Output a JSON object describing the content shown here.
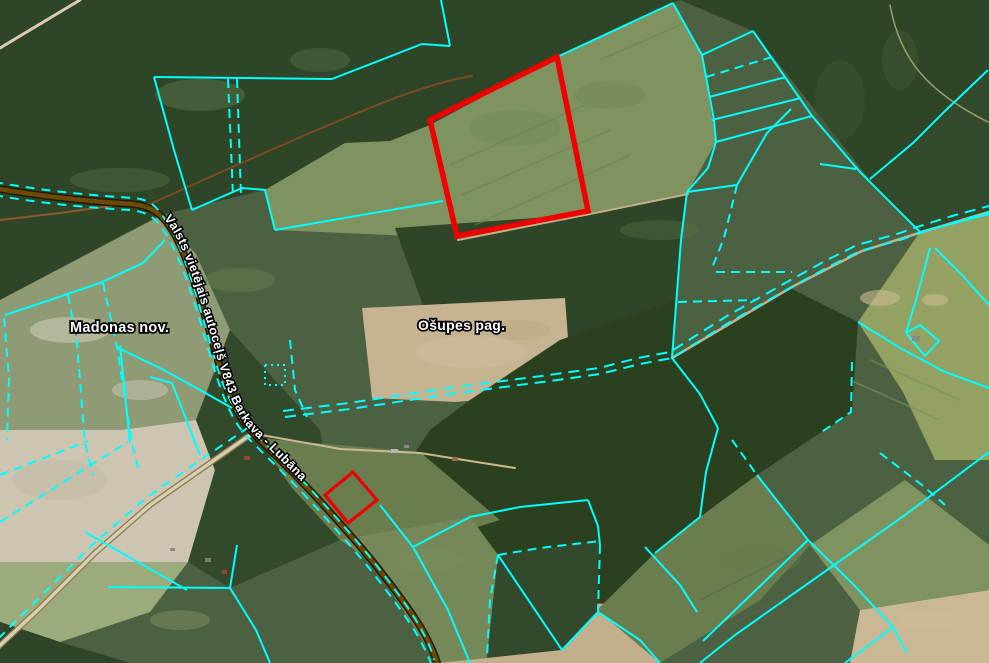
{
  "map": {
    "labels": [
      {
        "id": "municipality-label",
        "text": "Madonas nov.",
        "x": 70,
        "y": 332,
        "size": 14.5
      },
      {
        "id": "parish-label",
        "text": "Ošupes pag.",
        "x": 418,
        "y": 330,
        "size": 14
      }
    ],
    "road_label": {
      "text": "Valsts vietējais autoceļš V843 Barkava - Lubāna",
      "offset": 175,
      "size": 12.5
    },
    "palette": {
      "base": "#4c6142",
      "forest1": "#2f4527",
      "forest2": "#33492b",
      "forest3": "#2b401f",
      "fieldLight": "#7f9361",
      "fieldMid": "#6a7d4e",
      "fieldMid2": "#75885a",
      "fieldGrey": "#8e9b74",
      "fieldRight": "#93a163",
      "tan": "#c6b392",
      "tanPale": "#cdc5b1",
      "tan2": "#c2b08c",
      "tan3": "#c9b893",
      "paleGreen": "#9cab7c",
      "cadastral": "#00ffff",
      "highlight": "#f00000",
      "roadCasing": "#241a00",
      "roadFill": "#6b4a05",
      "gravelCasing": "#8a7a50",
      "gravelFill": "#d8cfb2",
      "labelFill": "#ffffff",
      "labelStroke": "#000000"
    },
    "patches": [
      {
        "f": "forest1",
        "p": "0,0 470,0 430,125 390,141 345,143 265,190 160,215 0,300"
      },
      {
        "f": "forest1",
        "p": "470,0 680,0 673,3 557,57 430,125"
      },
      {
        "f": "fieldLight",
        "p": "430,125 557,57 673,3 702,55 716,142 687,193 590,213 457,238 275,230 265,190 345,143 390,141"
      },
      {
        "f": "forest1",
        "p": "680,0 989,0 989,70 913,143 870,180 753,31"
      },
      {
        "f": "forest2",
        "p": "989,70 989,212 920,232 868,180 913,143"
      },
      {
        "f": "fieldRight",
        "p": "920,232 989,212 989,460 935,460 903,392 858,322"
      },
      {
        "f": "forest1",
        "p": "395,228 590,214 686,194 676,300 560,340 430,325"
      },
      {
        "f": "tan",
        "p": "362,308 565,298 572,392 455,402 372,398"
      },
      {
        "f": "fieldGrey",
        "p": "0,300 160,216 196,254 230,330 196,420 120,430 0,430"
      },
      {
        "f": "tanPale",
        "p": "0,430 120,430 196,420 215,470 188,562 0,562"
      },
      {
        "f": "paleGreen",
        "p": "0,562 188,562 150,612 60,642 0,622"
      },
      {
        "f": "forest1",
        "p": "0,622 60,642 130,663 0,663"
      },
      {
        "f": "forest2",
        "p": "196,420 230,330 320,430 340,540 230,588 188,562 215,470"
      },
      {
        "f": "forest3",
        "p": "560,340 676,300 672,358 790,288 858,322 852,412 820,433 757,475 700,517 655,553 597,610 562,650 498,555 470,517 413,547 380,505 430,430 470,400"
      },
      {
        "f": "fieldMid",
        "p": "258,438 420,452 500,520 413,547 340,540 292,488"
      },
      {
        "f": "fieldMid2",
        "p": "340,540 470,517 498,555 487,658 437,663 372,562"
      },
      {
        "f": "tan2",
        "p": "437,663 487,658 497,600 640,605 660,663"
      },
      {
        "f": "forest2",
        "p": "498,555 600,541 597,612 562,650 487,658"
      },
      {
        "f": "fieldMid",
        "p": "655,553 700,517 757,475 810,545 760,600 660,663 597,610"
      },
      {
        "f": "tan3",
        "p": "850,663 860,610 989,590 989,663"
      },
      {
        "f": "fieldLight",
        "p": "810,545 905,480 989,545 989,590 860,610"
      }
    ],
    "blotches": [
      {
        "cx": 200,
        "cy": 95,
        "rx": 45,
        "ry": 16,
        "c": "#5a7347",
        "o": 0.5
      },
      {
        "cx": 320,
        "cy": 60,
        "rx": 30,
        "ry": 12,
        "c": "#55704a",
        "o": 0.45
      },
      {
        "cx": 120,
        "cy": 180,
        "rx": 50,
        "ry": 12,
        "c": "#587348",
        "o": 0.4
      },
      {
        "cx": 70,
        "cy": 330,
        "rx": 40,
        "ry": 13,
        "c": "#dad4c4",
        "o": 0.5
      },
      {
        "cx": 140,
        "cy": 390,
        "rx": 28,
        "ry": 10,
        "c": "#d5cfbf",
        "o": 0.45
      },
      {
        "cx": 60,
        "cy": 480,
        "rx": 48,
        "ry": 20,
        "c": "#bab4a3",
        "o": 0.35
      },
      {
        "cx": 470,
        "cy": 352,
        "rx": 55,
        "ry": 16,
        "c": "#cdbd9e",
        "o": 0.5
      },
      {
        "cx": 520,
        "cy": 330,
        "rx": 30,
        "ry": 10,
        "c": "#b7a47e",
        "o": 0.4
      },
      {
        "cx": 880,
        "cy": 298,
        "rx": 20,
        "ry": 8,
        "c": "#ccba93",
        "o": 0.6
      },
      {
        "cx": 935,
        "cy": 300,
        "rx": 13,
        "ry": 6,
        "c": "#ccba93",
        "o": 0.6
      },
      {
        "cx": 515,
        "cy": 128,
        "rx": 45,
        "ry": 18,
        "c": "#71894f",
        "o": 0.4
      },
      {
        "cx": 610,
        "cy": 95,
        "rx": 35,
        "ry": 14,
        "c": "#6d854d",
        "o": 0.4
      },
      {
        "cx": 840,
        "cy": 100,
        "rx": 25,
        "ry": 40,
        "c": "#3d5531",
        "o": 0.5
      },
      {
        "cx": 900,
        "cy": 60,
        "rx": 18,
        "ry": 30,
        "c": "#405835",
        "o": 0.5
      },
      {
        "cx": 240,
        "cy": 280,
        "rx": 35,
        "ry": 12,
        "c": "#6a8050",
        "o": 0.45
      },
      {
        "cx": 430,
        "cy": 560,
        "rx": 35,
        "ry": 12,
        "c": "#7b8e5c",
        "o": 0.4
      },
      {
        "cx": 760,
        "cy": 560,
        "rx": 40,
        "ry": 14,
        "c": "#687b4e",
        "o": 0.4
      },
      {
        "cx": 930,
        "cy": 620,
        "rx": 30,
        "ry": 10,
        "c": "#cdbc96",
        "o": 0.5
      },
      {
        "cx": 180,
        "cy": 620,
        "rx": 30,
        "ry": 10,
        "c": "#8d9c6d",
        "o": 0.4
      },
      {
        "cx": 660,
        "cy": 230,
        "rx": 40,
        "ry": 10,
        "c": "#587043",
        "o": 0.4
      }
    ],
    "texture_lines": [
      {
        "pts": "450,165 585,105",
        "c": "#6e8452"
      },
      {
        "pts": "462,195 610,130",
        "c": "#6e8452"
      },
      {
        "pts": "475,225 630,155",
        "c": "#6e8452"
      },
      {
        "pts": "600,60 680,25",
        "c": "#6e8452"
      },
      {
        "pts": "870,360 960,400",
        "c": "#7d8f5a"
      },
      {
        "pts": "850,380 940,420",
        "c": "#7d8f5a"
      },
      {
        "pts": "700,600 790,555",
        "c": "#55684a"
      },
      {
        "pts": "730,625 820,580",
        "c": "#55684a"
      }
    ],
    "tracks": [
      {
        "d": "M 0,220 L 60,213 110,206 148,204",
        "c": "#8a5a2a",
        "w": 2
      },
      {
        "d": "M 150,204 C 230,168 330,123 395,98 C 430,85 458,78 472,76",
        "c": "#7a4c22",
        "w": 2
      },
      {
        "d": "M 0,48 L 80,0",
        "c": "#d6cdb0",
        "w": 3
      },
      {
        "d": "M 458,240 L 590,214 688,194",
        "c": "#c3b18a",
        "w": 2
      },
      {
        "d": "M 672,358 L 736,320 792,287 862,251 922,232 989,212",
        "c": "#c3b18a",
        "w": 2.5
      },
      {
        "d": "M 256,434 L 340,449 420,453 470,461 515,468",
        "c": "#cbb98e",
        "w": 2
      },
      {
        "d": "M 890,5 C 900,60 928,92 988,122",
        "c": "#96a070",
        "w": 1.5
      }
    ],
    "main_road": {
      "d": "M -6,188 C 50,198 100,202 132,204 C 152,206 162,214 172,230 C 188,256 202,305 216,354 C 228,396 238,418 253,433 C 272,452 298,477 318,499 C 338,521 356,541 374,563 C 392,586 412,612 424,633 C 432,648 436,657 438,666",
      "casing_w": 7.5,
      "fill_w": 4.5
    },
    "gravel_road": {
      "d": "M 253,433 L 200,470 150,505 95,553 40,608 -5,650",
      "casing_w": 6,
      "fill_w": 3.5
    },
    "edge_dashes": [
      {
        "d": "M -6,182 C 50,192 100,196 134,198 C 152,200 158,208 168,224 C 184,250 198,300 212,350 C 224,392 234,412 248,427 C 268,447 294,471 314,493 C 334,515 352,535 370,557 C 388,580 408,606 420,627 C 428,642 432,651 434,660"
      },
      {
        "d": "M -6,195 C 50,205 98,208 130,210 C 150,212 158,220 167,236 C 183,262 197,310 211,358 C 223,400 234,424 249,439 C 268,458 293,482 313,504 C 333,526 351,546 369,568 C 387,591 407,617 419,638 C 427,653 431,662 433,670"
      },
      {
        "d": "M 249,427 L 196,463 146,498 91,546 36,601 -4,641"
      }
    ],
    "admin_boundary": [
      {
        "pts": "285,417 350,409 450,394 550,381 600,374 640,364 672,358 730,322 790,288 830,266 860,251 900,240 920,233 955,222 989,212"
      },
      {
        "pts": "283,411 349,403 449,388 549,375 599,368 638,358 670,352 727,316 787,282 827,260 857,245 897,234 917,227 952,216 989,206"
      }
    ],
    "cadastral_lines": [
      {
        "p": "154,77 332,79"
      },
      {
        "p": "154,77 174,150 192,210"
      },
      {
        "p": "192,210 242,188 266,190"
      },
      {
        "p": "332,79 422,44 450,46"
      },
      {
        "p": "450,46 441,0"
      },
      {
        "p": "557,57 673,3"
      },
      {
        "p": "673,3 702,55 714,120 716,142 708,168 687,192"
      },
      {
        "p": "702,55 753,31"
      },
      {
        "p": "709,97 786,77"
      },
      {
        "p": "712,120 801,98"
      },
      {
        "p": "716,142 812,116"
      },
      {
        "p": "753,31 812,116 860,172 920,232"
      },
      {
        "p": "988,70 944,112 913,143 870,179"
      },
      {
        "p": "820,164 856,169"
      },
      {
        "p": "687,192 737,185"
      },
      {
        "p": "737,185 767,133 791,109"
      },
      {
        "p": "687,192 681,240 672,358"
      },
      {
        "p": "672,358 700,394 718,428"
      },
      {
        "p": "718,428 706,472 700,517"
      },
      {
        "p": "700,517 655,553"
      },
      {
        "p": "858,322 900,348 945,372 989,388"
      },
      {
        "p": "935,248 962,275 989,305"
      },
      {
        "p": "920,232 989,214"
      },
      {
        "p": "930,248 916,300 906,333"
      },
      {
        "p": "906,333 920,325 939,341 925,356 906,333"
      },
      {
        "p": "989,452 905,515 820,575 735,635 700,663"
      },
      {
        "p": "757,475 808,540 852,583 893,627 907,653"
      },
      {
        "p": "808,540 758,588 703,641"
      },
      {
        "p": "893,627 845,663"
      },
      {
        "p": "5,315 50,300 100,283 143,263 165,240"
      },
      {
        "p": "120,345 130,443"
      },
      {
        "p": "118,348 160,368 200,390 232,408"
      },
      {
        "p": "85,532 187,590"
      },
      {
        "p": "108,587 230,588"
      },
      {
        "p": "230,588 256,630 270,663"
      },
      {
        "p": "230,588 237,545"
      },
      {
        "p": "150,377 172,383"
      },
      {
        "p": "172,383 200,455"
      },
      {
        "p": "265,190 275,230"
      },
      {
        "p": "275,230 443,201"
      },
      {
        "p": "380,505 413,547"
      },
      {
        "p": "413,547 448,610 470,663"
      },
      {
        "p": "413,547 470,517 520,507 588,500"
      },
      {
        "p": "588,500 598,526 600,545"
      },
      {
        "p": "598,612 562,650"
      },
      {
        "p": "598,612 640,640 660,663"
      },
      {
        "p": "498,555 562,650"
      },
      {
        "p": "645,547 680,585 697,612"
      },
      {
        "p": "706,77 772,57",
        "d": 1
      },
      {
        "p": "737,185 724,238 712,268",
        "d": 1
      },
      {
        "p": "716,272 792,272",
        "d": 1
      },
      {
        "p": "678,302 756,300",
        "d": 1
      },
      {
        "p": "852,362 851,412 820,433",
        "d": 1
      },
      {
        "p": "732,440 757,475",
        "d": 1
      },
      {
        "p": "880,453 922,485 945,505",
        "d": 1
      },
      {
        "p": "68,295 77,343 85,443 93,475",
        "d": 1
      },
      {
        "p": "103,283 117,347 132,443 138,468",
        "d": 1
      },
      {
        "p": "4,318 9,378 7,440",
        "d": 1
      },
      {
        "p": "0,475 88,441",
        "d": 1
      },
      {
        "p": "0,522 78,473 128,442",
        "d": 1
      },
      {
        "p": "290,340 295,390 307,417",
        "d": 1
      },
      {
        "p": "228,79 233,195",
        "d": 1
      },
      {
        "p": "237,79 241,195",
        "d": 1
      },
      {
        "p": "600,545 598,612",
        "d": 1
      },
      {
        "p": "498,555 540,548 600,541",
        "d": 1
      },
      {
        "p": "498,555 490,600 487,658",
        "d": 1
      },
      {
        "p": "265,365 285,365 285,385 265,385 265,365",
        "d": 2
      }
    ],
    "red_parcels": [
      {
        "p": "557,57 588,211 457,236 430,120",
        "w": 5.5
      },
      {
        "p": "353,472 377,500 348,523 325,495",
        "w": 3.2
      }
    ],
    "buildings": [
      {
        "x": 244,
        "y": 456,
        "w": 6,
        "h": 4,
        "c": "#a04030"
      },
      {
        "x": 391,
        "y": 449,
        "w": 7,
        "h": 4,
        "c": "#b5b5b0"
      },
      {
        "x": 404,
        "y": 445,
        "w": 5,
        "h": 3,
        "c": "#8a8a85"
      },
      {
        "x": 452,
        "y": 457,
        "w": 6,
        "h": 4,
        "c": "#9a6a50"
      },
      {
        "x": 205,
        "y": 558,
        "w": 6,
        "h": 4,
        "c": "#7c7c78"
      },
      {
        "x": 222,
        "y": 570,
        "w": 5,
        "h": 4,
        "c": "#a04030"
      },
      {
        "x": 170,
        "y": 548,
        "w": 5,
        "h": 3,
        "c": "#8d8d88"
      },
      {
        "x": 912,
        "y": 336,
        "w": 8,
        "h": 5,
        "c": "#8a8a80"
      }
    ]
  }
}
